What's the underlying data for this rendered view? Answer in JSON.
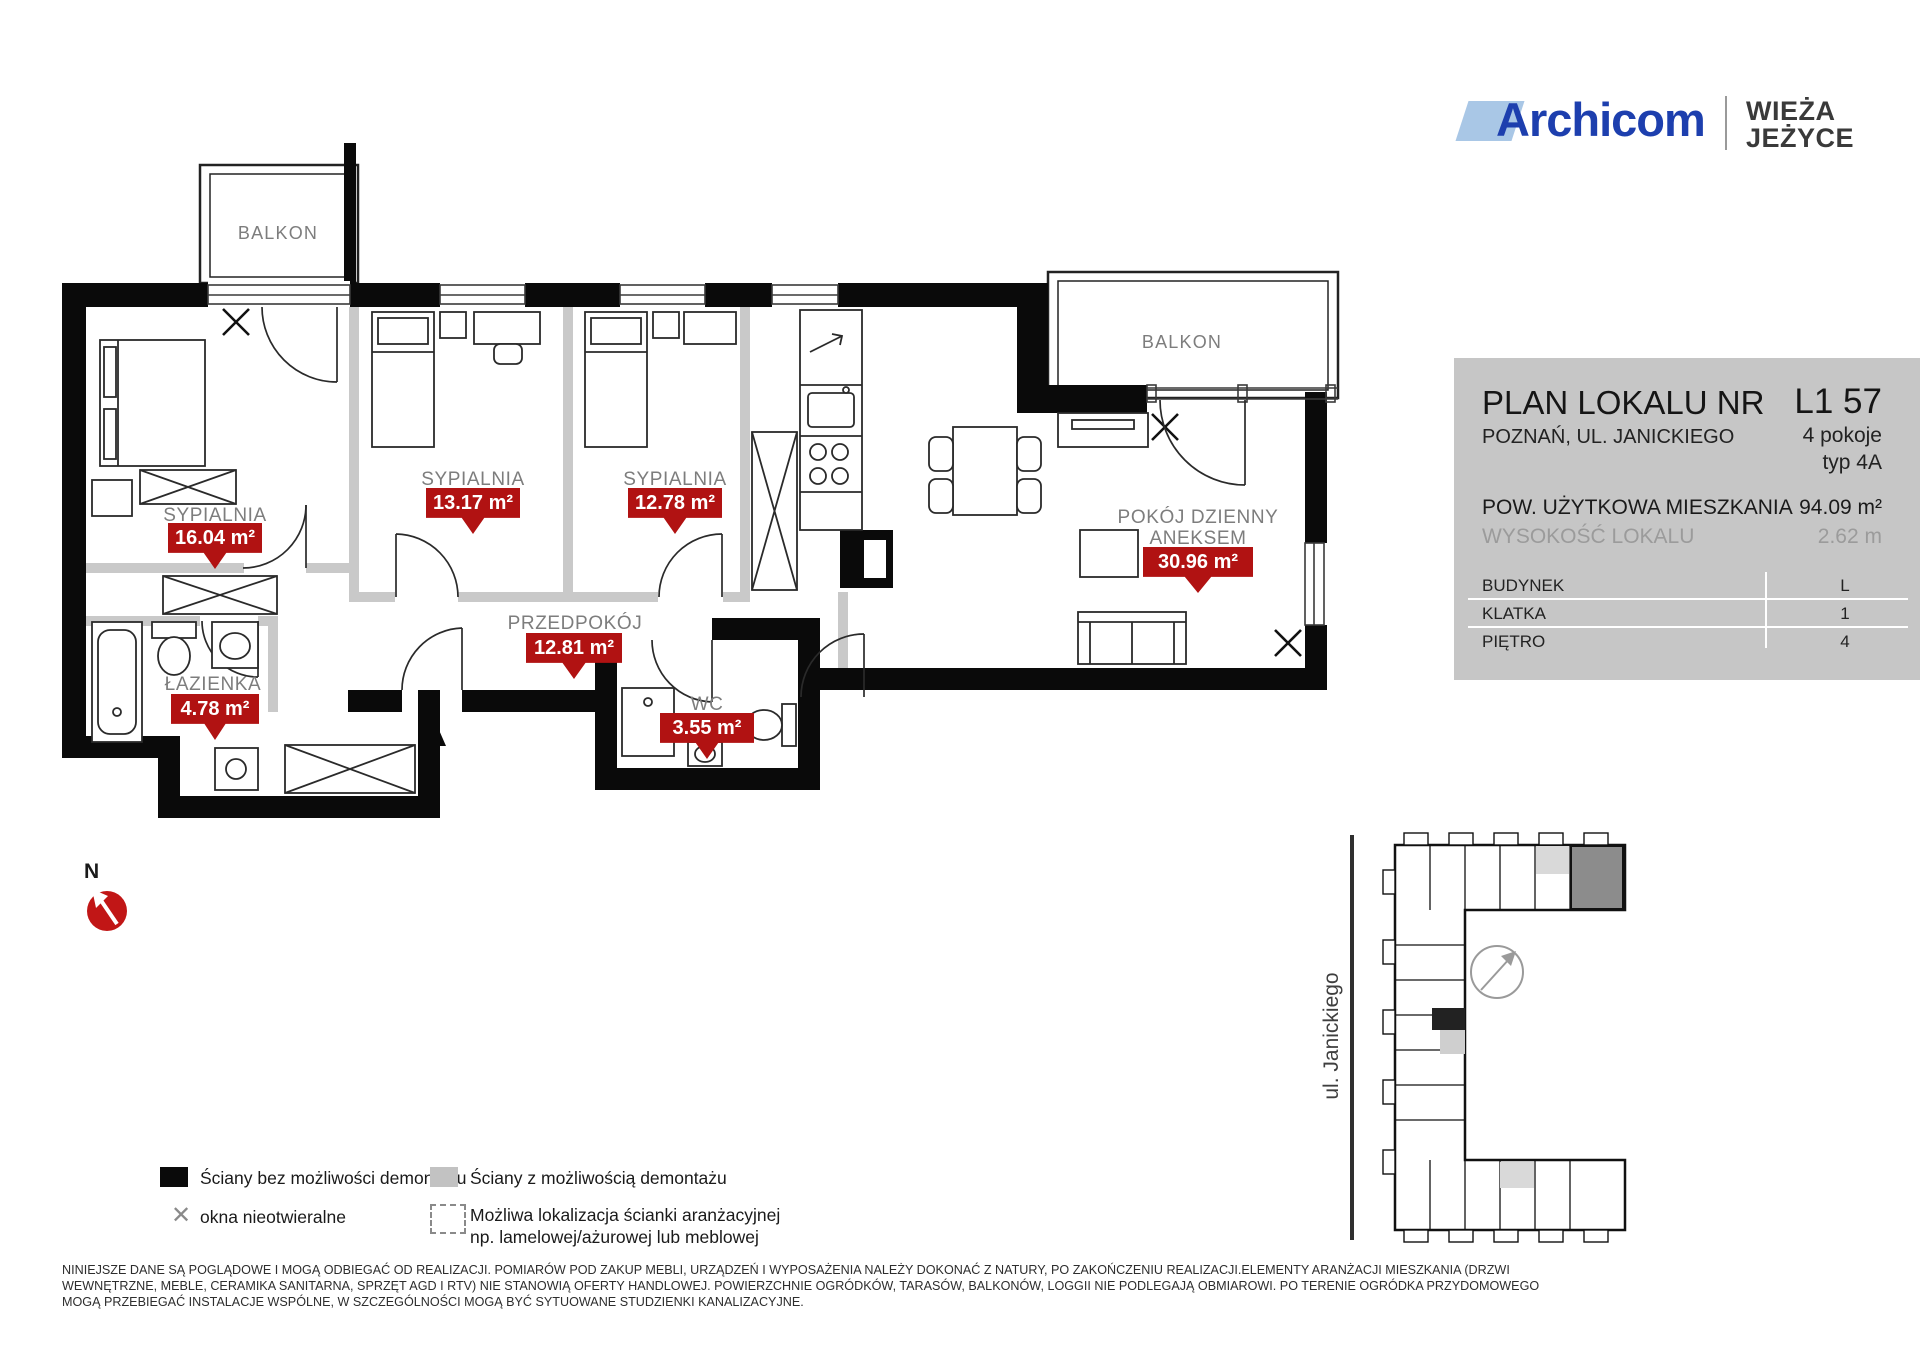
{
  "header": {
    "brand": "Archicom",
    "project_name_line1": "WIEŻA",
    "project_name_line2": "JEŻYCE"
  },
  "info_panel": {
    "title": "PLAN LOKALU NR",
    "unit_number": "L1 57",
    "address": "POZNAŃ, UL. JANICKIEGO",
    "rooms_count": "4 pokoje",
    "unit_type": "typ 4A",
    "area_label": "POW. UŻYTKOWA MIESZKANIA",
    "area_value": "94.09 m²",
    "height_label": "WYSOKOŚĆ LOKALU",
    "height_value": "2.62 m",
    "details": [
      {
        "label": "BUDYNEK",
        "value": "L"
      },
      {
        "label": "KLATKA",
        "value": "1"
      },
      {
        "label": "PIĘTRO",
        "value": "4"
      }
    ]
  },
  "plan": {
    "balcony_label_left": "BALKON",
    "balcony_label_right": "BALKON",
    "rooms": [
      {
        "name": "SYPIALNIA",
        "area": "16.04 m²"
      },
      {
        "name": "SYPIALNIA",
        "area": "13.17 m²"
      },
      {
        "name": "SYPIALNIA",
        "area": "12.78 m²"
      },
      {
        "name": "POKÓJ DZIENNY",
        "name_line2": "ANEKSEM",
        "area": "30.96 m²"
      },
      {
        "name": "PRZEDPOKÓJ",
        "area": "12.81 m²"
      },
      {
        "name": "ŁAZIENKA",
        "area": "4.78 m²"
      },
      {
        "name": "WC",
        "area": "3.55 m²"
      }
    ],
    "accent_red": "#b11212",
    "wall_black": "#0a0a0a",
    "wall_gray": "#c9c9c9"
  },
  "legend": {
    "items": [
      {
        "swatch": "black",
        "label": "Ściany bez możliwości demontażu"
      },
      {
        "swatch": "x",
        "label": "okna nieotwieralne"
      },
      {
        "swatch": "gray",
        "label": "Ściany z możliwością demontażu"
      },
      {
        "swatch": "dashed",
        "label": "Możliwa lokalizacja ścianki aranżacyjnej",
        "label_line2": "np. lamelowej/ażurowej lub meblowej"
      }
    ],
    "x_glyph": "✕"
  },
  "site_map": {
    "street_label": "ul. Janickiego"
  },
  "compass": {
    "north_label": "N"
  },
  "disclaimer": {
    "line1": "NINIEJSZE DANE SĄ POGLĄDOWE I MOGĄ ODBIEGAĆ OD REALIZACJI. POMIARÓW POD ZAKUP MEBLI, URZĄDZEŃ I WYPOSAŻENIA NALEŻY DOKONAĆ Z NATURY, PO ZAKOŃCZENIU REALIZACJI.ELEMENTY ARANŻACJI MIESZKANIA (DRZWI",
    "line2": "WEWNĘTRZNE, MEBLE, CERAMIKA SANITARNA, SPRZĘT AGD I RTV) NIE STANOWIĄ OFERTY HANDLOWEJ. POWIERZCHNIE OGRÓDKÓW, TARASÓW, BALKONÓW, LOGGII NIE PODLEGAJĄ OBMIAROWI. PO TERENIE OGRÓDKA PRZYDOMOWEGO",
    "line3": "MOGĄ PRZEBIEGAĆ INSTALACJE WSPÓLNE,  W SZCZEGÓLNOŚCI MOGĄ BYĆ SYTUOWANE STUDZIENKI KANALIZACYJNE."
  }
}
